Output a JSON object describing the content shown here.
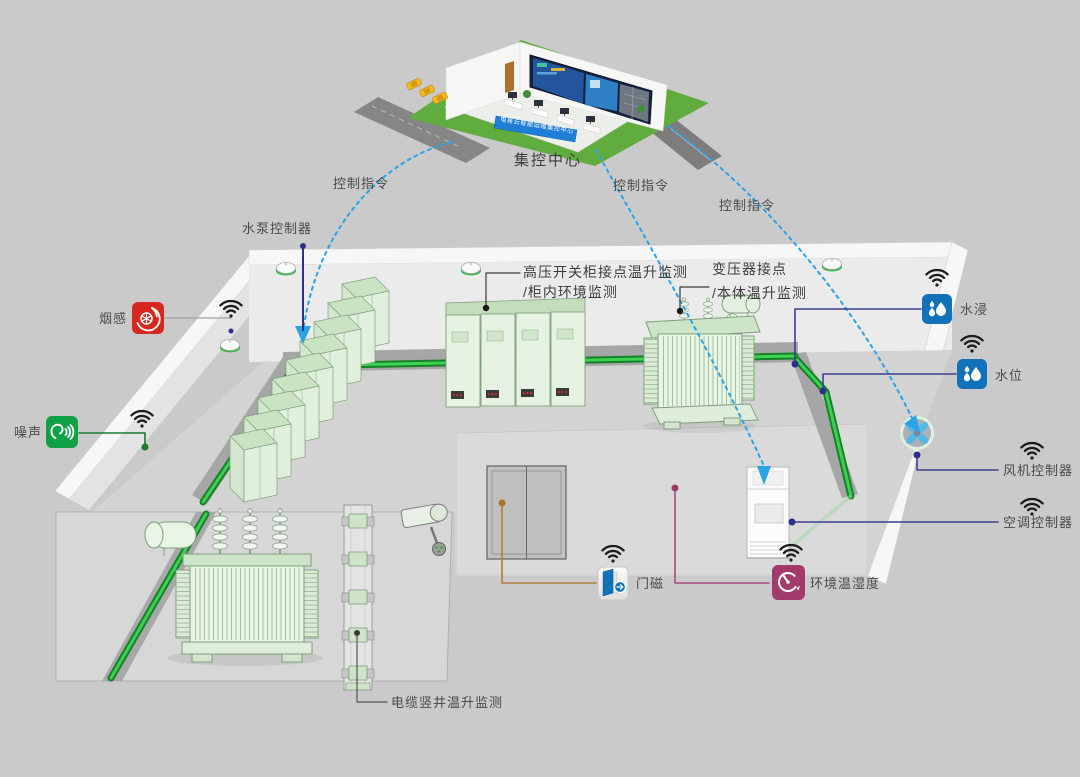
{
  "background": {
    "color": "#cacaca"
  },
  "control_center": {
    "label": "集控中心",
    "banner_text": "电易云智能运维集控中心"
  },
  "command_flows": {
    "labels": [
      "控制指令",
      "控制指令",
      "控制指令"
    ],
    "dash_color": "#2aa3e6"
  },
  "sensors": {
    "pump_controller": {
      "label": "水泵控制器",
      "line_color": "#2b3187"
    },
    "smoke": {
      "label": "烟感",
      "color": "#d6281e",
      "icon": "smoke-swirl-icon"
    },
    "noise": {
      "label": "噪声",
      "color": "#0fa148",
      "icon": "ear-sound-waves-icon"
    },
    "water_immersion": {
      "label": "水浸",
      "color": "#1172b9",
      "icon": "water-drops-icon"
    },
    "water_level": {
      "label": "水位",
      "color": "#1172b9",
      "icon": "water-drops-icon"
    },
    "fan_controller": {
      "label": "风机控制器",
      "line_color": "#2b3187"
    },
    "ac_controller": {
      "label": "空调控制器",
      "line_color": "#2b3187"
    },
    "door_magnet": {
      "label": "门磁",
      "color": "#1172b9",
      "icon": "open-door-arrow-icon"
    },
    "temp_humidity": {
      "label": "环境温湿度",
      "color": "#a23b6b",
      "icon": "gauge-icon"
    }
  },
  "monitoring_labels": {
    "hv_switchgear": {
      "line1": "高压开关柜接点温升监测",
      "line2": "/柜内环境监测"
    },
    "transformer": {
      "line1": "变压器接点",
      "line2": "/本体温升监测"
    },
    "cable_shaft": {
      "line1": "电缆竖井温升监测"
    }
  }
}
